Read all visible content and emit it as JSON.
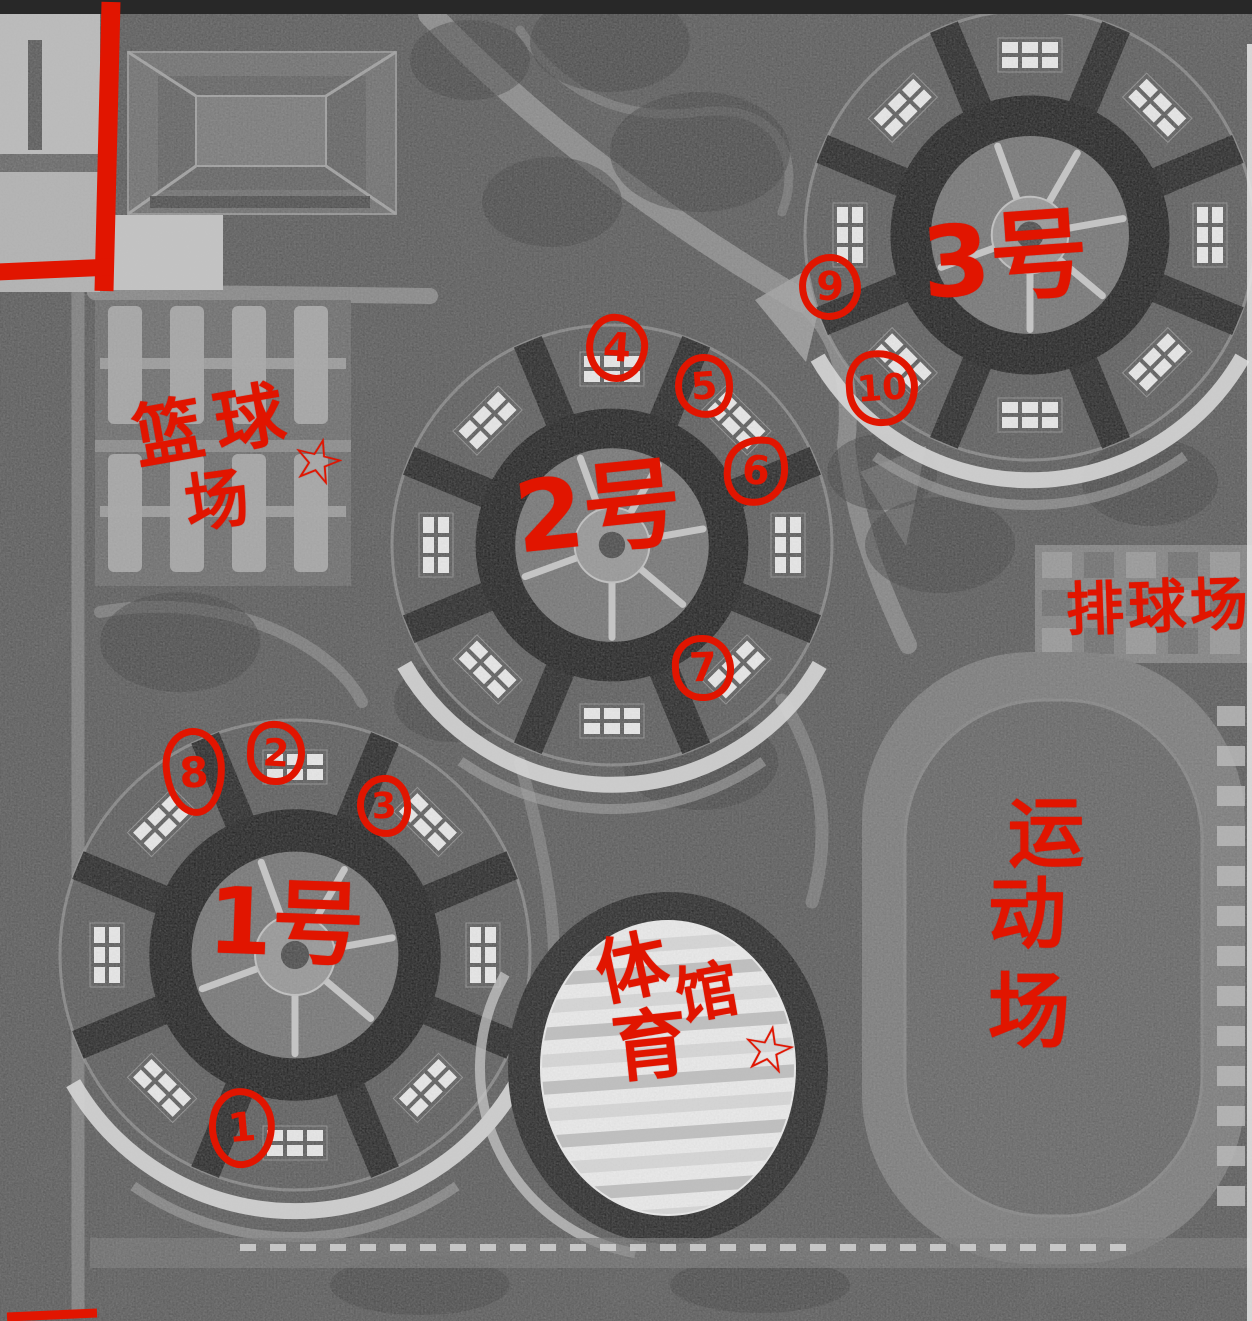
{
  "annotations": {
    "red_color": "#e11500",
    "buildings": {
      "b1": "1号",
      "b2": "2号",
      "b3": "3号"
    },
    "areas": {
      "basketball_l1": "篮球",
      "basketball_l2": "场",
      "basketball_star": "☆",
      "volleyball": "排球场",
      "sports_c1": "运",
      "sports_c2": "动",
      "sports_c3": "场",
      "gym_c1": "体",
      "gym_c2": "馆",
      "gym_c3": "育",
      "gym_star": "☆"
    },
    "markers": {
      "m1": "1",
      "m2": "2",
      "m3": "3",
      "m4": "4",
      "m5": "5",
      "m6": "6",
      "m7": "7",
      "m8": "8",
      "m9": "9",
      "m10": "10"
    }
  }
}
